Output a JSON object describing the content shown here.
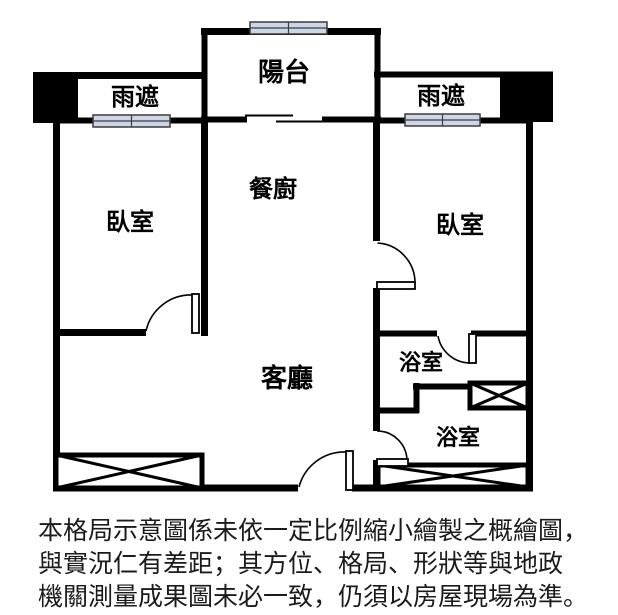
{
  "colors": {
    "background": "#ffffff",
    "wall": "#000000",
    "window_fill": "#ccd6e6",
    "window_border": "#3c3c3c",
    "text": "#000000"
  },
  "labels": {
    "balcony": "陽台",
    "rain_cover_left": "雨遮",
    "rain_cover_right": "雨遮",
    "dining_kitchen": "餐廚",
    "bedroom_left": "臥室",
    "bedroom_right": "臥室",
    "living_room": "客廳",
    "bathroom_upper": "浴室",
    "bathroom_lower": "浴室"
  },
  "disclaimer": {
    "line1": "本格局示意圖係未依一定比例縮小繪製之概繪圖，",
    "line2": "與實況仁有差距；其方位、格局、形狀等與地政",
    "line3": "機關測量成果圖未必一致，仍須以房屋現場為準。"
  }
}
